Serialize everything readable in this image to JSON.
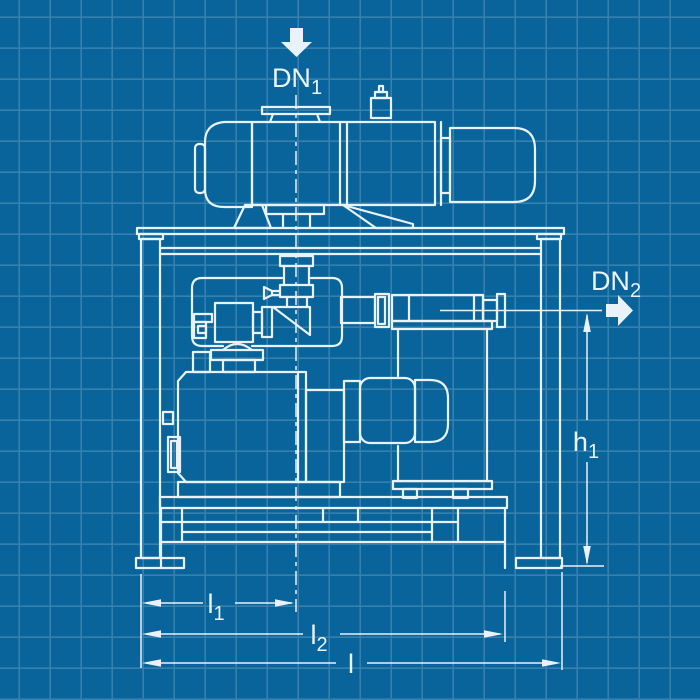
{
  "colors": {
    "background": "#08649a",
    "grid": "rgba(255,255,255,0.18)",
    "line": "#e9f2f8",
    "text": "#eaf3f8"
  },
  "labels": {
    "inlet": {
      "text": "DN",
      "sub": "1"
    },
    "outlet": {
      "text": "DN",
      "sub": "2"
    },
    "height1": {
      "text": "h",
      "sub": "1"
    },
    "length1": {
      "text": "l",
      "sub": "1"
    },
    "length2": {
      "text": "l",
      "sub": "2"
    },
    "length_overall": {
      "text": "l",
      "sub": ""
    }
  },
  "components": [
    "roots-vacuum-pump",
    "roots-pump-motor",
    "inlet-flange",
    "oil-fill-plug",
    "support-frame",
    "heat-exchanger",
    "small-pump-unit",
    "drain-funnel",
    "rotary-vane-backing-pump",
    "backing-pump-motor",
    "oil-sight-glass",
    "exhaust-filter-tank",
    "outlet-flange",
    "base-skid"
  ]
}
